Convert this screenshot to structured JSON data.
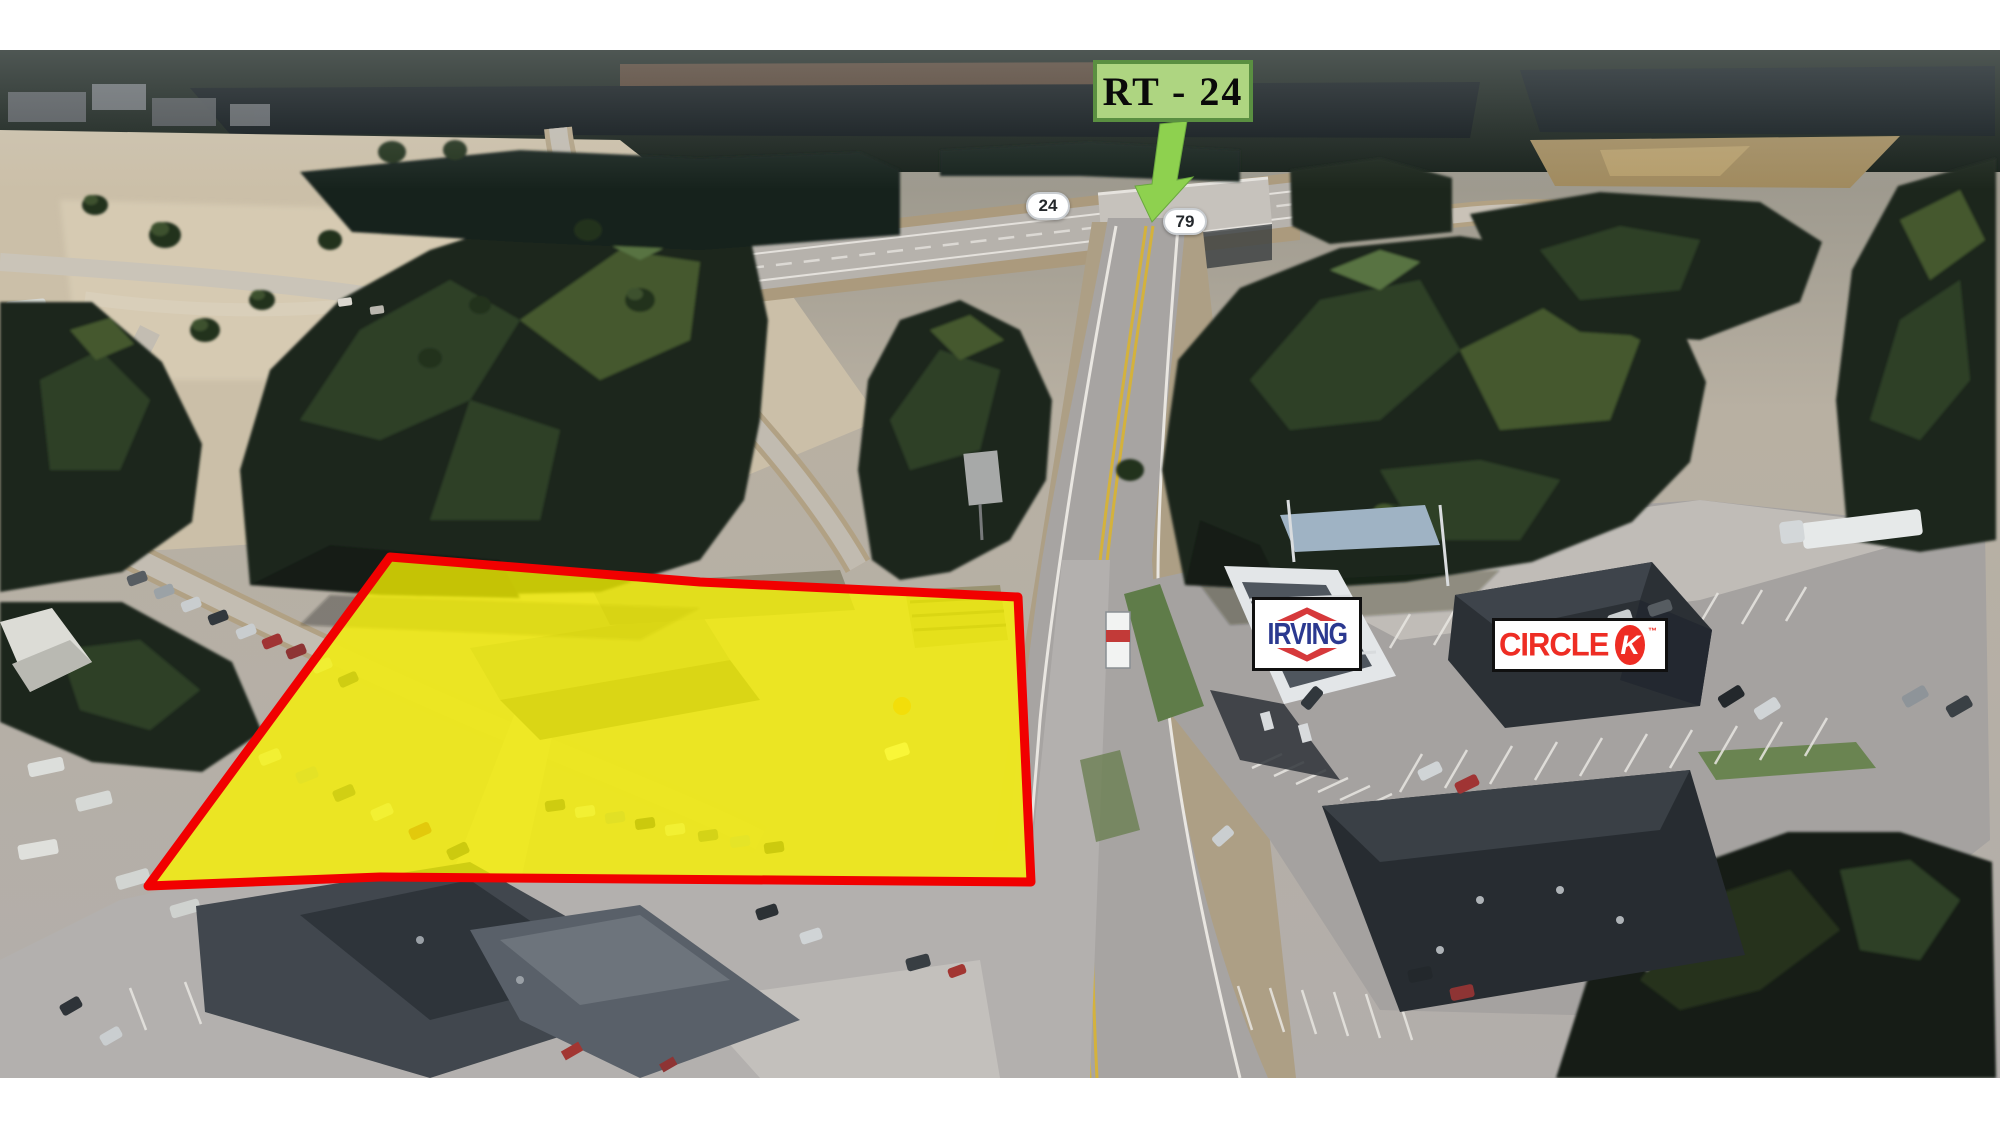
{
  "annotations": {
    "route_label": {
      "text": "RT - 24"
    },
    "route_shields": [
      {
        "text": "24"
      },
      {
        "text": "79"
      }
    ],
    "signs": {
      "irving": {
        "text": "IRVING"
      },
      "circle_k": {
        "word": "CIRCLE",
        "letter": "K",
        "trademark": "™"
      }
    },
    "parcel_highlight": {
      "fill": "#fdf800",
      "outline": "#f10000"
    },
    "colors": {
      "route_label_bg": "#aed581",
      "route_label_border": "#5a8f41",
      "arrow_green": "#8ed14f",
      "irving_blue": "#2b3990",
      "irving_red": "#d6393b",
      "circle_k_red": "#ee2d24"
    }
  }
}
